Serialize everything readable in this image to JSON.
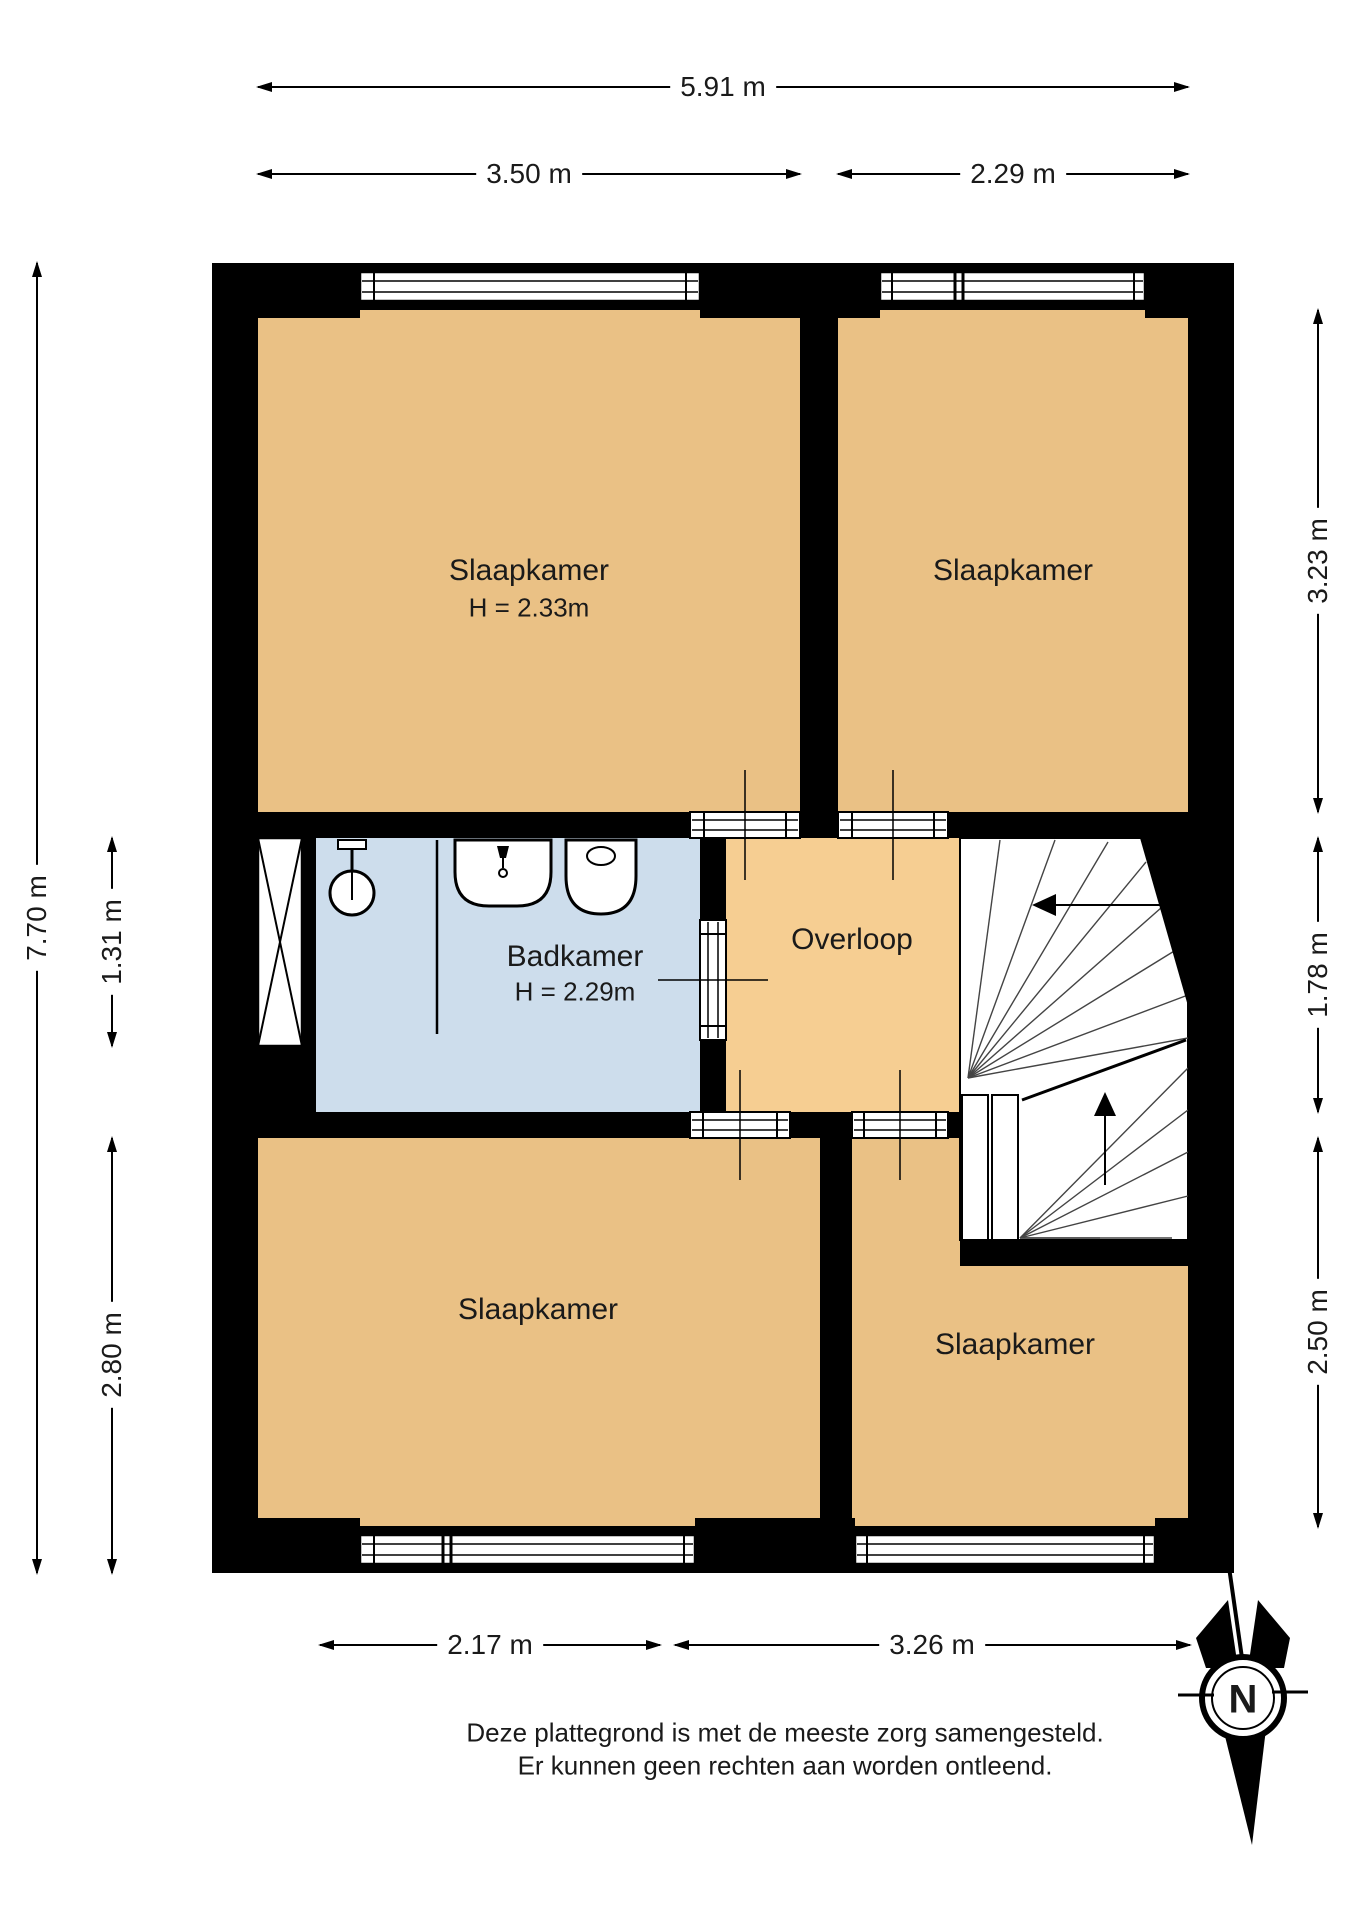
{
  "floorplan": {
    "rooms": {
      "bedroom_top_left": {
        "label": "Slaapkamer",
        "ceiling_height": "H = 2.33m"
      },
      "bedroom_top_right": {
        "label": "Slaapkamer"
      },
      "bathroom": {
        "label": "Badkamer",
        "ceiling_height": "H = 2.29m"
      },
      "landing": {
        "label": "Overloop"
      },
      "bedroom_bottom_left": {
        "label": "Slaapkamer"
      },
      "bedroom_bottom_right": {
        "label": "Slaapkamer"
      }
    },
    "dimensions": {
      "top_total": "5.91 m",
      "top_left": "3.50 m",
      "top_right": "2.29 m",
      "left_total": "7.70 m",
      "left_middle": "1.31 m",
      "left_bottom": "2.80 m",
      "right_top": "3.23 m",
      "right_middle": "1.78 m",
      "right_bottom": "2.50 m",
      "bottom_left": "2.17 m",
      "bottom_right": "3.26 m"
    },
    "compass": {
      "label": "N"
    },
    "disclaimer": {
      "line1": "Deze plattegrond is met de meeste zorg samengesteld.",
      "line2": "Er kunnen geen rechten aan worden ontleend."
    },
    "colors": {
      "room": "#eac185",
      "landing": "#f6ce92",
      "bathroom": "#cdddec",
      "wall": "#000000"
    }
  }
}
